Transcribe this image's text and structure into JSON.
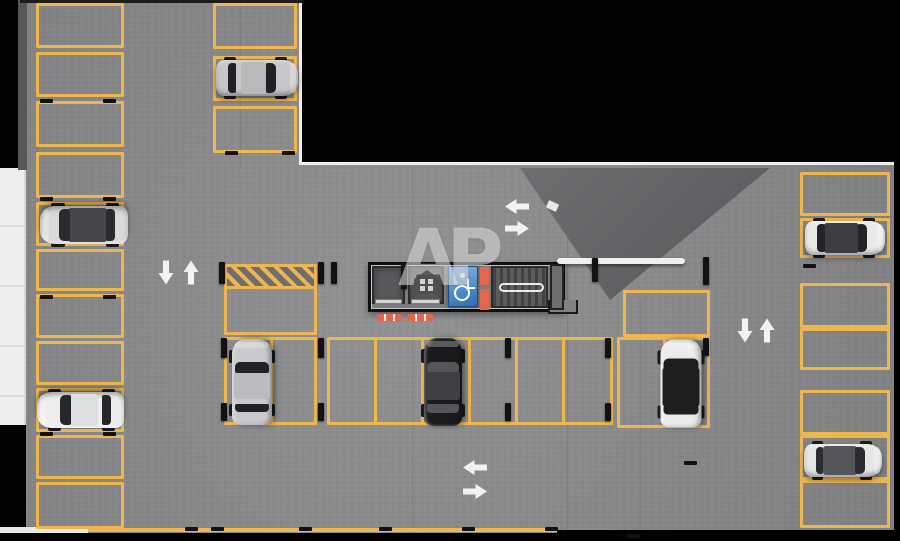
{
  "meta": {
    "title": "Underground parking level floor plan render"
  },
  "watermark": {
    "text": "AP"
  },
  "palette": {
    "floor_gray": "#8b8b8d",
    "line_yellow": "#eeb64f",
    "outline_black": "#020202",
    "wall_white": "#efeeec",
    "ramp_shadow": "#616164",
    "fire_orange": "#e4674d",
    "accessible_blue": "#2e6bb0",
    "car_silver": "#c6c7c9",
    "car_white": "#ededee",
    "car_black": "#1b1b1d"
  },
  "plan": {
    "columns": [
      {
        "name": "left-wall-column",
        "x": 36,
        "w": 88,
        "spaces": [
          [
            3,
            45
          ],
          [
            52,
            45
          ],
          [
            101,
            46
          ],
          [
            152,
            46
          ],
          [
            202,
            44
          ],
          [
            249,
            42
          ],
          [
            294,
            44
          ],
          [
            341,
            44
          ],
          [
            388,
            44
          ],
          [
            435,
            44
          ],
          [
            482,
            47
          ]
        ]
      },
      {
        "name": "top-inner-column",
        "x": 213,
        "w": 84,
        "spaces": [
          [
            3,
            46
          ],
          [
            56,
            45
          ],
          [
            106,
            47
          ]
        ]
      },
      {
        "name": "right-wall-column",
        "x": 800,
        "w": 90,
        "spaces": [
          [
            172,
            44
          ],
          [
            218,
            40
          ],
          [
            283,
            45
          ],
          [
            328,
            42
          ],
          [
            390,
            45
          ],
          [
            435,
            45
          ],
          [
            480,
            48
          ]
        ]
      }
    ],
    "blocks": [
      {
        "name": "center-row-left",
        "x": 224,
        "y": 337,
        "w": 93,
        "h": 88,
        "dividers": [
          270
        ]
      },
      {
        "name": "center-row-main",
        "x": 327,
        "y": 337,
        "w": 286,
        "h": 88,
        "dividers": [
          374,
          421,
          468,
          515,
          562
        ]
      },
      {
        "name": "center-row-right",
        "x": 617,
        "y": 337,
        "w": 93,
        "h": 91,
        "dividers": [
          663
        ]
      },
      {
        "name": "upper-right-single",
        "x": 623,
        "y": 290,
        "w": 87,
        "h": 47
      },
      {
        "name": "upper-left-single",
        "x": 224,
        "y": 286,
        "w": 93,
        "h": 49
      }
    ],
    "hatch": {
      "x": 224,
      "y": 264,
      "w": 93,
      "h": 25
    },
    "core": {
      "x": 368,
      "y": 262,
      "w": 197,
      "h": 50,
      "rooms": [
        {
          "t": "shaft",
          "name": "elevator-shaft-1",
          "x": 372,
          "y": 266,
          "w": 33,
          "h": 38
        },
        {
          "t": "shaft",
          "name": "elevator-shaft-2",
          "x": 408,
          "y": 266,
          "w": 36,
          "h": 38
        },
        {
          "t": "accessible",
          "name": "accessible-parking-sign",
          "x": 448,
          "y": 266,
          "w": 30,
          "h": 41
        },
        {
          "t": "orange",
          "name": "fire-equipment-stripe",
          "x": 480,
          "y": 267,
          "w": 9,
          "h": 18
        },
        {
          "t": "orange",
          "name": "fire-equipment-stripe",
          "x": 480,
          "y": 289,
          "w": 9,
          "h": 21
        },
        {
          "t": "stair",
          "name": "stairwell",
          "x": 491,
          "y": 266,
          "w": 57,
          "h": 42
        },
        {
          "t": "handrail",
          "name": "stair-handrail",
          "x": 499,
          "y": 283,
          "w": 45,
          "h": 9
        },
        {
          "t": "room",
          "name": "shaft-room",
          "x": 550,
          "y": 264,
          "w": 14,
          "h": 46
        },
        {
          "t": "roomext",
          "name": "core-step",
          "x": 548,
          "y": 300,
          "w": 30,
          "h": 14
        },
        {
          "t": "threshold",
          "name": "elevator-threshold",
          "x": 375,
          "y": 299,
          "w": 27,
          "h": 5
        },
        {
          "t": "threshold",
          "name": "elevator-threshold",
          "x": 411,
          "y": 299,
          "w": 29,
          "h": 5
        },
        {
          "t": "mat",
          "name": "elevator-mat",
          "x": 377,
          "y": 314,
          "w": 25,
          "h": 7
        },
        {
          "t": "mat",
          "name": "elevator-mat",
          "x": 408,
          "y": 314,
          "w": 25,
          "h": 7
        },
        {
          "t": "beam",
          "name": "wall-beam",
          "x": 557,
          "y": 258,
          "w": 128,
          "h": 6
        }
      ]
    },
    "cars": [
      {
        "name": "silver-hatchback-top",
        "cx": 257,
        "cy": 78,
        "len": 82,
        "wid": 40,
        "rot": 0,
        "body": "#c6c7c9",
        "roof": "#b8b9bb",
        "glass": "#202124",
        "open": false
      },
      {
        "name": "gray-suv-left",
        "cx": 84,
        "cy": 225,
        "len": 88,
        "wid": 42,
        "rot": 180,
        "body": "#d9d9d9",
        "roof": "#46474a",
        "glass": "#2a2b2e",
        "open": true
      },
      {
        "name": "white-sedan-left",
        "cx": 80,
        "cy": 410,
        "len": 87,
        "wid": 40,
        "rot": 180,
        "body": "#ededee",
        "roof": "#dfdfe1",
        "glass": "#26272a",
        "open": false
      },
      {
        "name": "silver-sedan-center",
        "cx": 252,
        "cy": 382,
        "len": 86,
        "wid": 44,
        "rot": -90,
        "body": "#c9cacd",
        "roof": "#bbbcbf",
        "glass": "#212225",
        "open": false
      },
      {
        "name": "black-sedan-center",
        "cx": 443,
        "cy": 382,
        "len": 88,
        "wid": 42,
        "rot": -90,
        "body": "#1b1b1d",
        "roof": "#3f4043",
        "glass": "#55565a",
        "open": false
      },
      {
        "name": "white-black-roof-car",
        "cx": 681,
        "cy": 383,
        "len": 88,
        "wid": 45,
        "rot": -90,
        "body": "#ebebec",
        "roof": "#1e1e20",
        "glass": "#1e1e20",
        "open": true
      },
      {
        "name": "white-suv-right-top",
        "cx": 845,
        "cy": 238,
        "len": 80,
        "wid": 38,
        "rot": 0,
        "body": "#e9e9ea",
        "roof": "#3d3e41",
        "glass": "#232427",
        "open": true
      },
      {
        "name": "gray-car-right-bottom",
        "cx": 843,
        "cy": 460,
        "len": 78,
        "wid": 37,
        "rot": 0,
        "body": "#e6e6e7",
        "roof": "#55565a",
        "glass": "#2b2c2f",
        "open": true
      }
    ],
    "arrows": [
      {
        "x": 517,
        "y": 206,
        "dir": "left"
      },
      {
        "x": 517,
        "y": 228,
        "dir": "right"
      },
      {
        "x": 166,
        "y": 272,
        "dir": "down"
      },
      {
        "x": 191,
        "y": 272,
        "dir": "up"
      },
      {
        "x": 745,
        "y": 330,
        "dir": "down"
      },
      {
        "x": 767,
        "y": 330,
        "dir": "up"
      },
      {
        "x": 475,
        "y": 467,
        "dir": "left"
      },
      {
        "x": 475,
        "y": 491,
        "dir": "right"
      }
    ],
    "posts": [
      [
        219,
        262,
        22
      ],
      [
        318,
        262,
        22
      ],
      [
        331,
        262,
        22
      ],
      [
        401,
        263,
        26
      ],
      [
        592,
        258,
        24
      ],
      [
        703,
        257,
        28
      ],
      [
        221,
        338,
        20
      ],
      [
        221,
        403,
        18
      ],
      [
        318,
        338,
        20
      ],
      [
        318,
        403,
        18
      ],
      [
        505,
        338,
        20
      ],
      [
        505,
        403,
        18
      ],
      [
        605,
        338,
        20
      ],
      [
        605,
        403,
        18
      ],
      [
        703,
        338,
        18
      ]
    ],
    "ticks": [
      [
        40,
        99
      ],
      [
        103,
        99
      ],
      [
        40,
        197
      ],
      [
        103,
        197
      ],
      [
        40,
        295
      ],
      [
        103,
        295
      ],
      [
        40,
        432
      ],
      [
        103,
        432
      ],
      [
        225,
        151
      ],
      [
        282,
        151
      ],
      [
        803,
        264
      ],
      [
        185,
        527
      ],
      [
        211,
        527
      ],
      [
        299,
        527
      ],
      [
        379,
        527
      ],
      [
        462,
        527
      ],
      [
        545,
        527
      ],
      [
        627,
        534
      ],
      [
        684,
        461
      ]
    ],
    "seams": [
      [
        412,
        168,
        1,
        365
      ],
      [
        567,
        168,
        1,
        365
      ],
      [
        640,
        300,
        1,
        233
      ],
      [
        240,
        0,
        1,
        168
      ]
    ]
  }
}
